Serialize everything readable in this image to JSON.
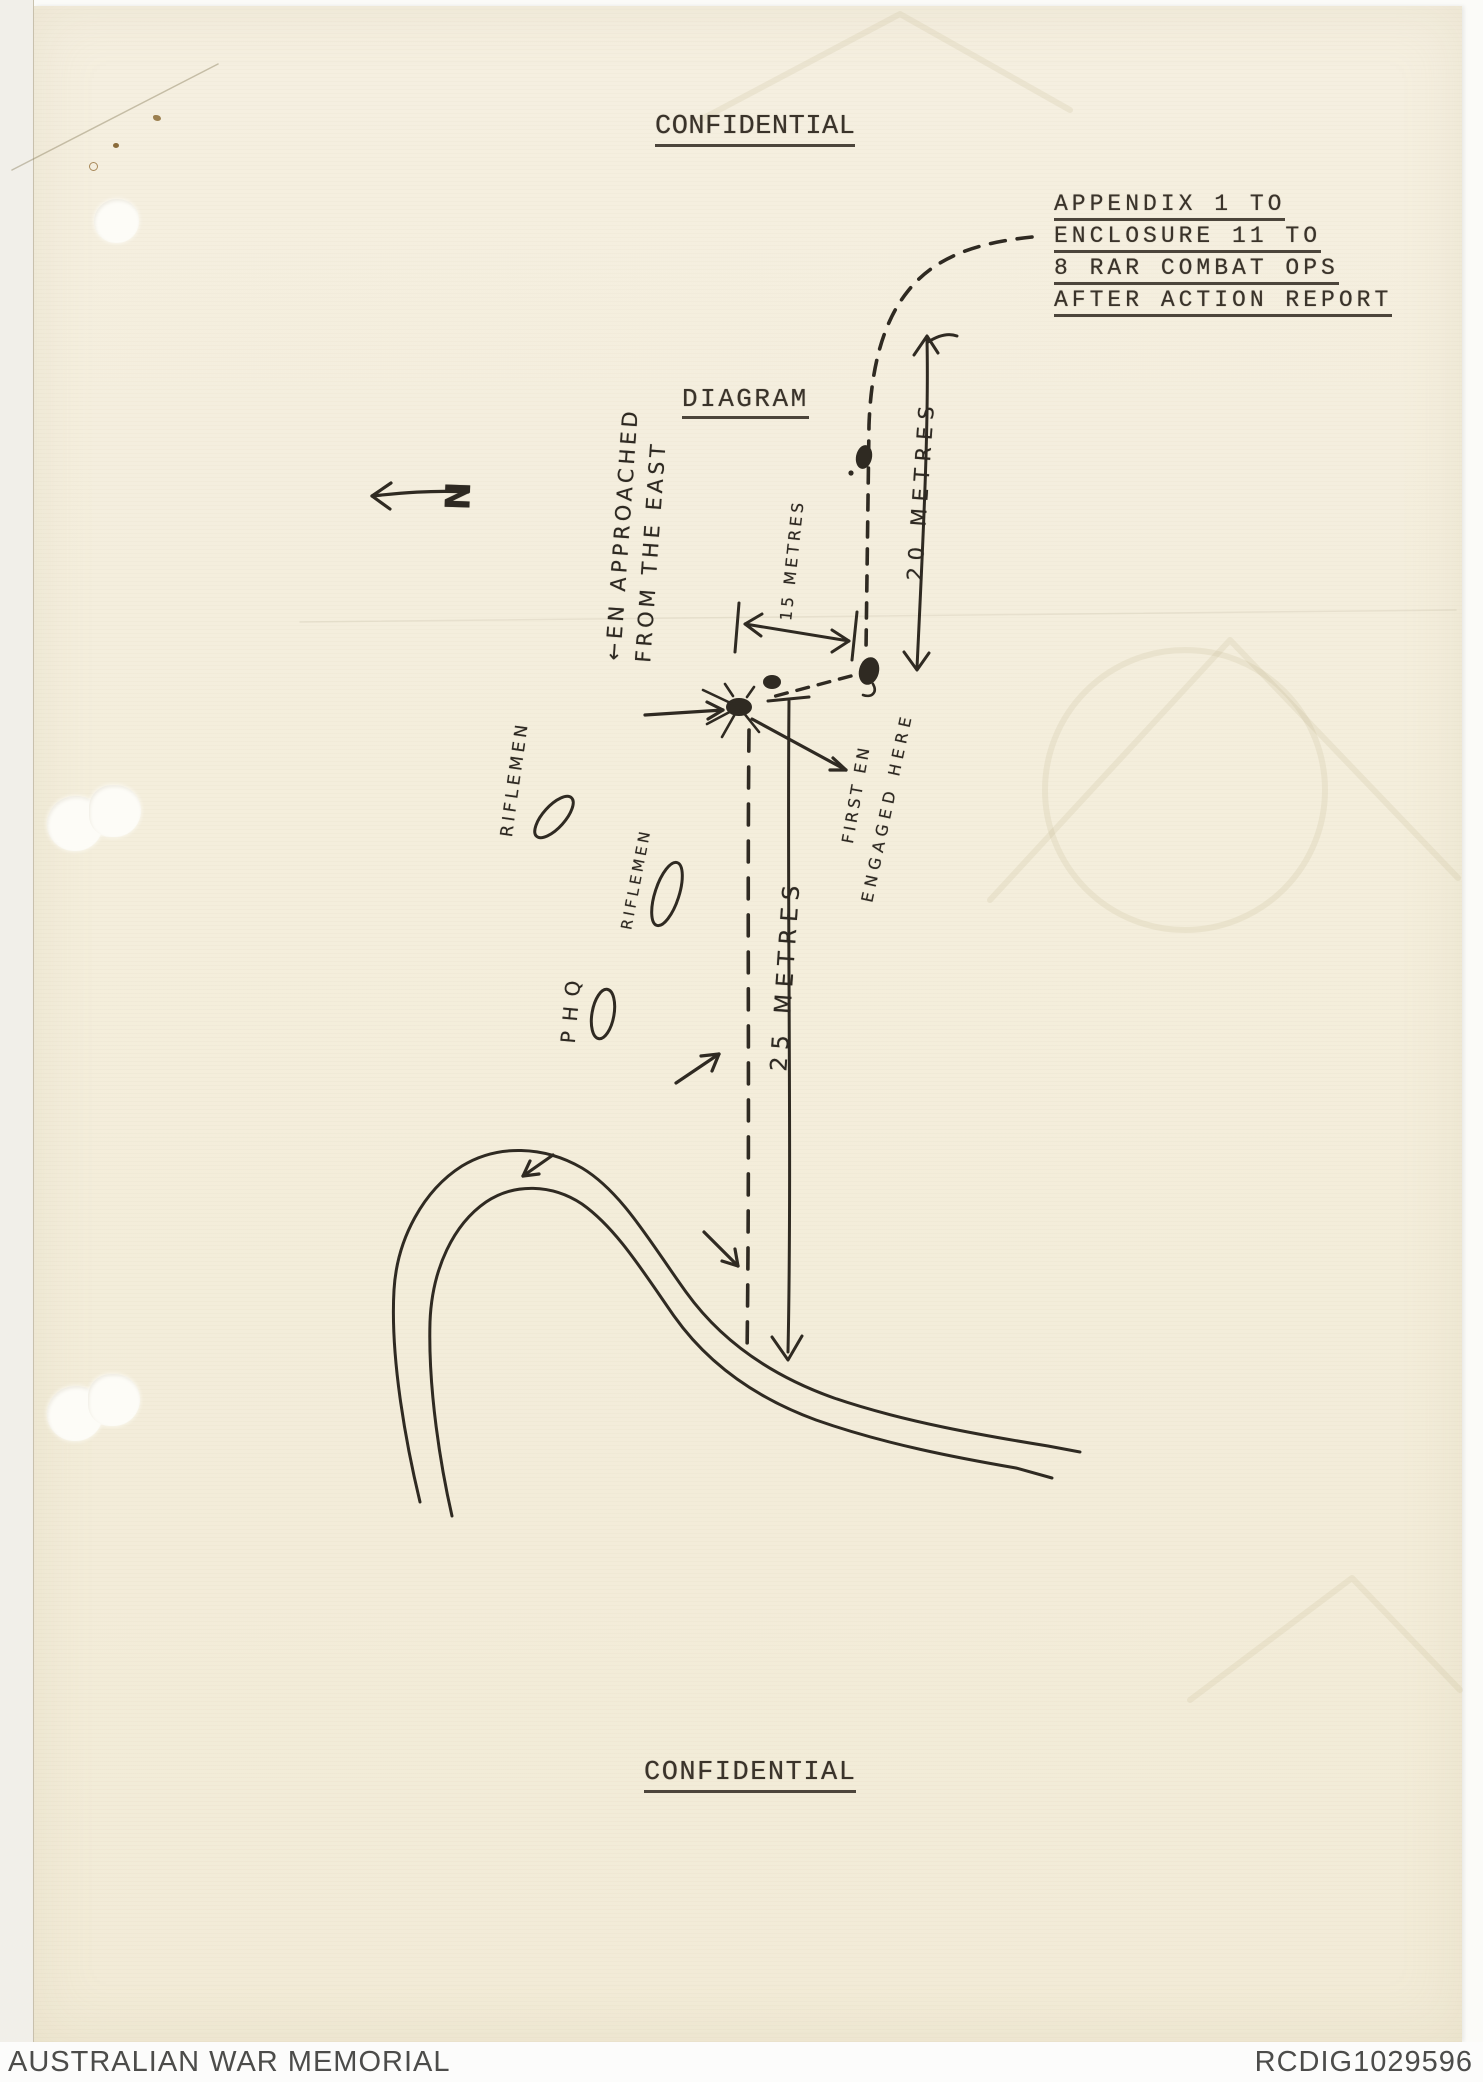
{
  "document": {
    "classification_top": "CONFIDENTIAL",
    "classification_bottom": "CONFIDENTIAL",
    "appendix": [
      "APPENDIX 1 TO",
      "ENCLOSURE 11 TO",
      "8 RAR COMBAT OPS",
      "AFTER ACTION REPORT"
    ],
    "title": "DIAGRAM"
  },
  "diagram": {
    "north_label": "N",
    "labels": {
      "approach_line1": "←EN APPROACHED",
      "approach_line2": "FROM THE EAST",
      "distance_15": "15 METRES",
      "distance_20": "20 METRES",
      "distance_25": "25 METRES",
      "riflemen_1": "RIFLEMEN",
      "riflemen_2": "RIFLEMEN",
      "phq": "PHQ",
      "first_engaged_line1": "FIRST EN",
      "first_engaged_line2": "ENGAGED HERE"
    },
    "symbols": [
      "north-arrow",
      "enemy-approach-dashed-track",
      "contact-starburst",
      "enemy-position-dots",
      "riflemen-position-ellipses",
      "phq-position-ellipse",
      "creek-double-line",
      "measurement-arrows"
    ]
  },
  "footer": {
    "archive": "AUSTRALIAN WAR MEMORIAL",
    "reference": "RCDIG1029596"
  },
  "colors": {
    "paper": "#f4eedc",
    "ink": "#2f2a22",
    "typewriter_ink": "#3a332a",
    "footer_background": "#fcfcfb",
    "footer_text": "#4c4c4a"
  }
}
